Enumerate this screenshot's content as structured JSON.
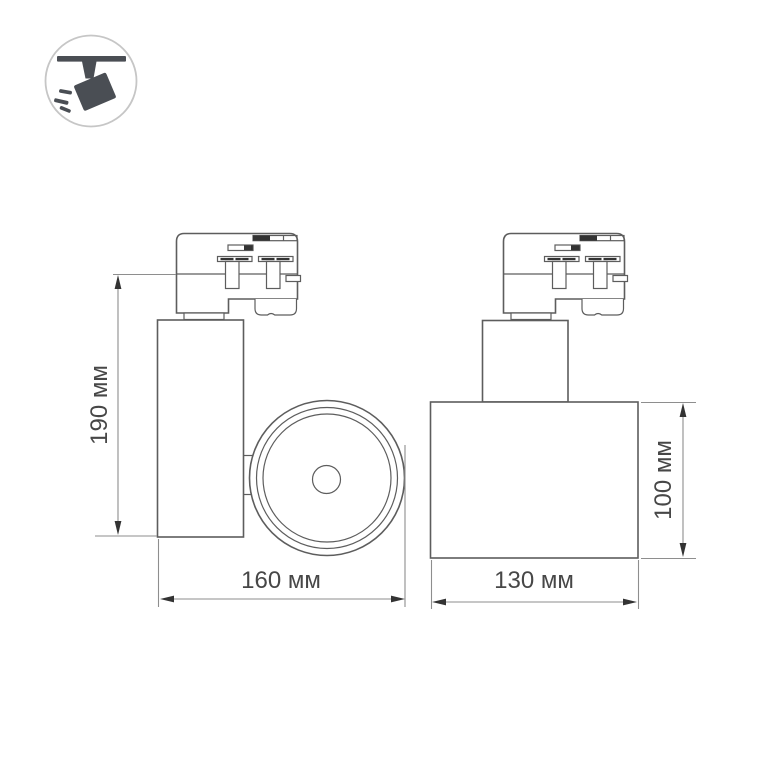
{
  "colors": {
    "bg": "#ffffff",
    "line": "#5d5d5d",
    "dim-line": "#8e8e8e",
    "text": "#474747",
    "arrow": "#333333",
    "icon-fill": "#4a4e54",
    "icon-ring": "#c6c6c6"
  },
  "icon": {
    "name": "ceiling-track-spotlight-icon",
    "description": "circled pictogram of a spotlight hanging from a ceiling track"
  },
  "views": {
    "front": {
      "name": "front-view"
    },
    "side": {
      "name": "side-view"
    }
  },
  "dimensions": {
    "front_height": {
      "label": "190 мм",
      "value": 190,
      "unit": "мм",
      "orientation": "vertical"
    },
    "front_width": {
      "label": "160 мм",
      "value": 160,
      "unit": "мм",
      "orientation": "horizontal"
    },
    "side_width": {
      "label": "130 мм",
      "value": 130,
      "unit": "мм",
      "orientation": "horizontal"
    },
    "side_height": {
      "label": "100 мм",
      "value": 100,
      "unit": "мм",
      "orientation": "vertical"
    }
  }
}
